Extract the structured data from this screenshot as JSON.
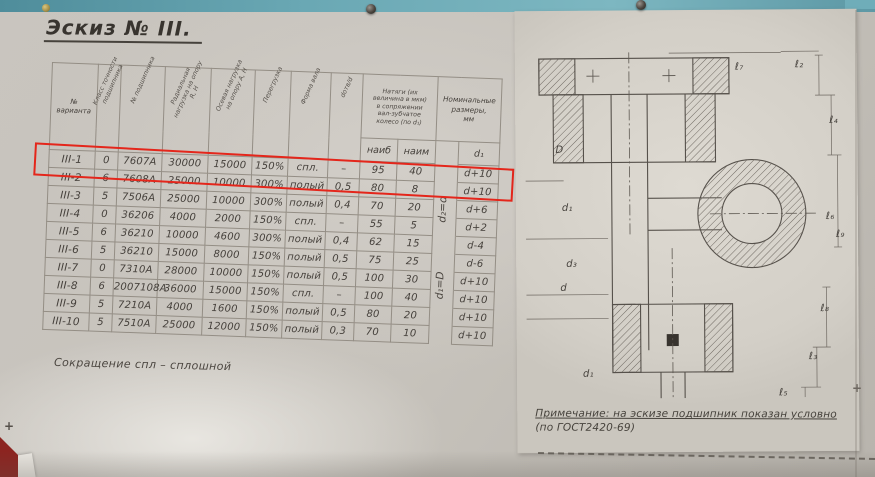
{
  "title": "Эскиз № III.",
  "table": {
    "headers": {
      "variant": "№\nварианта",
      "accuracy_class": "Класс точности подшипника",
      "bearing_no": "№ подшипника",
      "radial_load": "Радиальная нагрузка на опору R, Н",
      "axial_load": "Осевая нагрузка на опору А, Н",
      "overload": "Перегрузка",
      "shaft_form": "Форма вала",
      "bore_ratio": "dотв/d",
      "interference_group": "Натяги (их\nвеличина в мкм)\nв сопряжении\nвал-зубчатое\nколесо (по d₁)",
      "naib": "наиб",
      "naim": "наим",
      "nominal_group": "Номинальные\nразмеры,\nмм",
      "d1": "d₁",
      "formula_upper": "d₂=d",
      "formula_lower": "d₁=D"
    },
    "rows": [
      {
        "variant": "III-1",
        "accuracy": "0",
        "bearing": "7607А",
        "radial": "30000",
        "axial": "15000",
        "overload": "150%",
        "form": "спл.",
        "bore": "–",
        "naib": "95",
        "naim": "40",
        "d1": "d+10",
        "highlighted": true
      },
      {
        "variant": "III-2",
        "accuracy": "6",
        "bearing": "7608А",
        "radial": "25000",
        "axial": "10000",
        "overload": "300%",
        "form": "полый",
        "bore": "0,5",
        "naib": "80",
        "naim": "8",
        "d1": "d+10",
        "highlighted": false
      },
      {
        "variant": "III-3",
        "accuracy": "5",
        "bearing": "7506А",
        "radial": "25000",
        "axial": "10000",
        "overload": "300%",
        "form": "полый",
        "bore": "0,4",
        "naib": "70",
        "naim": "20",
        "d1": "d+6",
        "highlighted": false
      },
      {
        "variant": "III-4",
        "accuracy": "0",
        "bearing": "36206",
        "radial": "4000",
        "axial": "2000",
        "overload": "150%",
        "form": "спл.",
        "bore": "–",
        "naib": "55",
        "naim": "5",
        "d1": "d+2",
        "highlighted": false
      },
      {
        "variant": "III-5",
        "accuracy": "6",
        "bearing": "36210",
        "radial": "10000",
        "axial": "4600",
        "overload": "300%",
        "form": "полый",
        "bore": "0,4",
        "naib": "62",
        "naim": "15",
        "d1": "d-4",
        "highlighted": false
      },
      {
        "variant": "III-6",
        "accuracy": "5",
        "bearing": "36210",
        "radial": "15000",
        "axial": "8000",
        "overload": "150%",
        "form": "полый",
        "bore": "0,5",
        "naib": "75",
        "naim": "25",
        "d1": "d-6",
        "highlighted": false
      },
      {
        "variant": "III-7",
        "accuracy": "0",
        "bearing": "7310А",
        "radial": "28000",
        "axial": "10000",
        "overload": "150%",
        "form": "полый",
        "bore": "0,5",
        "naib": "100",
        "naim": "30",
        "d1": "d+10",
        "highlighted": false
      },
      {
        "variant": "III-8",
        "accuracy": "6",
        "bearing": "2007108А",
        "radial": "36000",
        "axial": "15000",
        "overload": "150%",
        "form": "спл.",
        "bore": "–",
        "naib": "100",
        "naim": "40",
        "d1": "d+10",
        "highlighted": false
      },
      {
        "variant": "III-9",
        "accuracy": "5",
        "bearing": "7210А",
        "radial": "4000",
        "axial": "1600",
        "overload": "150%",
        "form": "полый",
        "bore": "0,5",
        "naib": "80",
        "naim": "20",
        "d1": "d+10",
        "highlighted": false
      },
      {
        "variant": "III-10",
        "accuracy": "5",
        "bearing": "7510А",
        "radial": "25000",
        "axial": "12000",
        "overload": "150%",
        "form": "полый",
        "bore": "0,3",
        "naib": "70",
        "naim": "10",
        "d1": "d+10",
        "highlighted": false
      }
    ]
  },
  "footnote": "Сокращение  спл – сплошной",
  "drawing": {
    "dim_labels": [
      "D",
      "d₁",
      "d₃",
      "d",
      "d₁",
      "ℓ₇",
      "ℓ₂",
      "ℓ₄",
      "ℓ₆",
      "ℓ₉",
      "ℓ₈",
      "ℓ₃",
      "ℓ₅"
    ],
    "note_line1": "Примечание: на эскизе подшипник показан условно",
    "note_line2": "(по ГОСТ2420-69)"
  },
  "colors": {
    "wall": "#5d9aa8",
    "board": "#c6c2bb",
    "paper": "#d8d4cc",
    "ink": "#45403b",
    "highlight_box": "#e4261b"
  }
}
